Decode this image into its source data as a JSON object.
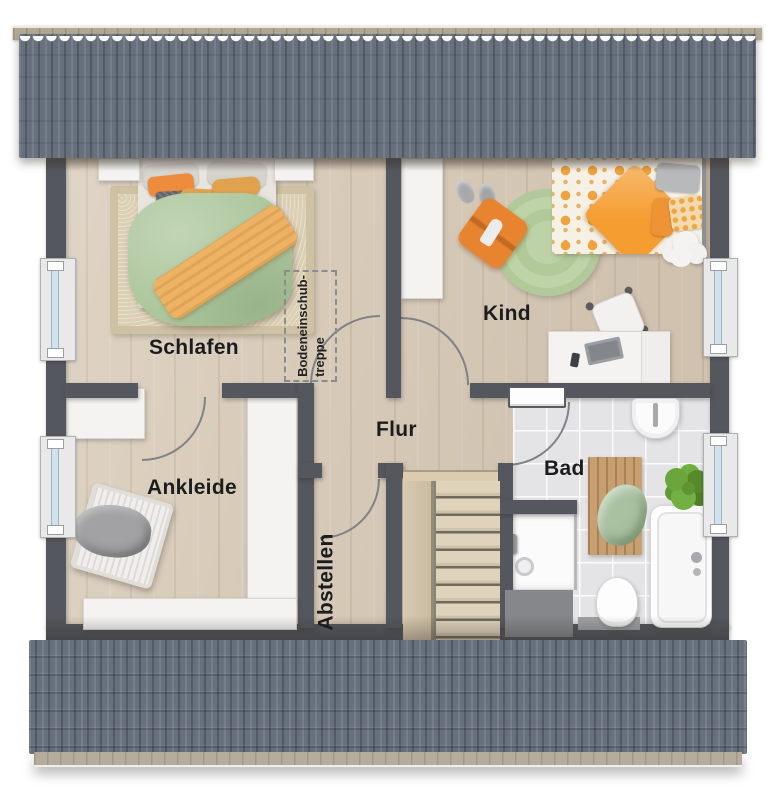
{
  "rooms": {
    "schlafen": {
      "label": "Schlafen"
    },
    "kind": {
      "label": "Kind"
    },
    "ankleide": {
      "label": "Ankleide"
    },
    "flur": {
      "label": "Flur"
    },
    "abstellen": {
      "label": "Abstellen"
    },
    "bad": {
      "label": "Bad"
    }
  },
  "attic_hatch": {
    "line1": "Bodeneinschub-",
    "line2": "treppe"
  },
  "colors": {
    "wall": "#54575d",
    "roof_tiles": "#67707d",
    "roof_ridge": "#b3a995",
    "wood_floor": "#d8cbb9",
    "bath_tile": "#e4e4e7",
    "accent_orange": "#ec8a3e",
    "accent_green": "#adc79d",
    "window_glass": "#cfe2ee"
  }
}
